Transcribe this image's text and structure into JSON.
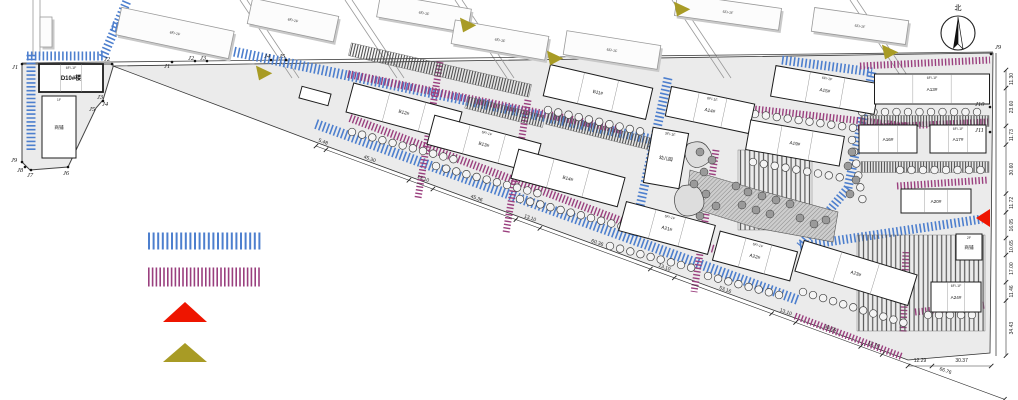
{
  "north_label": "北",
  "colors": {
    "road_main_hatch": "#4d7fce",
    "road_secondary_hatch": "#9a3f7e",
    "arrow_red": "#ee1500",
    "arrow_olive": "#a89b25",
    "site_fill": "#ebebeb"
  },
  "legend": {
    "items": [
      {
        "name": "legend-main-road-hatch",
        "kind": "hatch",
        "color": "#4d7fce"
      },
      {
        "name": "legend-secondary-road-hatch",
        "kind": "hatch",
        "color": "#9a3f7e"
      },
      {
        "name": "legend-red-entrance-arrow",
        "kind": "arrow",
        "color": "#ee1500"
      },
      {
        "name": "legend-olive-entrance-arrow",
        "kind": "arrow",
        "color": "#a89b25"
      }
    ]
  },
  "buildings": [
    {
      "label": "D10#楼",
      "sub": "6F/-1F",
      "x": 71,
      "y": 78,
      "w": 64,
      "h": 28,
      "rot": 0,
      "bold": true
    },
    {
      "label": "商铺",
      "sub": "1F",
      "x": 59,
      "y": 127,
      "w": 34,
      "h": 62,
      "rot": 0
    },
    {
      "label": "",
      "x": 315,
      "y": 96,
      "w": 30,
      "h": 12,
      "rot": 15
    },
    {
      "label": "B12#",
      "x": 404,
      "y": 112,
      "w": 112,
      "h": 30,
      "rot": 15
    },
    {
      "label": "B13#",
      "sub": "6F/-1F",
      "x": 484,
      "y": 144,
      "w": 110,
      "h": 30,
      "rot": 15
    },
    {
      "label": "B14#",
      "x": 568,
      "y": 178,
      "w": 110,
      "h": 30,
      "rot": 15
    },
    {
      "label": "B11#",
      "x": 598,
      "y": 92,
      "w": 105,
      "h": 32,
      "rot": 13
    },
    {
      "label": "A14#",
      "sub": "6F/-1F",
      "x": 710,
      "y": 110,
      "w": 85,
      "h": 30,
      "rot": 12
    },
    {
      "label": "A15#",
      "sub": "6F/-1F",
      "x": 825,
      "y": 90,
      "w": 105,
      "h": 31,
      "rot": 10
    },
    {
      "label": "A19#",
      "x": 795,
      "y": 143,
      "w": 95,
      "h": 30,
      "rot": 10
    },
    {
      "label": "幼儿园",
      "sub": "3F/-1F",
      "x": 666,
      "y": 158,
      "w": 36,
      "h": 56,
      "rot": 10
    },
    {
      "label": "A13#",
      "sub": "6F/-1F",
      "x": 932,
      "y": 89,
      "w": 115,
      "h": 30,
      "rot": 0
    },
    {
      "label": "A16#",
      "x": 888,
      "y": 139,
      "w": 58,
      "h": 28,
      "rot": 0
    },
    {
      "label": "A17#",
      "sub": "6F/-1F",
      "x": 958,
      "y": 139,
      "w": 56,
      "h": 28,
      "rot": 0
    },
    {
      "label": "A20#",
      "x": 936,
      "y": 201,
      "w": 70,
      "h": 24,
      "rot": 0
    },
    {
      "label": "A21#",
      "sub": "6F/-1F",
      "x": 667,
      "y": 228,
      "w": 92,
      "h": 30,
      "rot": 15
    },
    {
      "label": "A22#",
      "sub": "6F/-1F",
      "x": 755,
      "y": 256,
      "w": 80,
      "h": 30,
      "rot": 15
    },
    {
      "label": "A23#",
      "x": 856,
      "y": 273,
      "w": 118,
      "h": 32,
      "rot": 17
    },
    {
      "label": "A24#",
      "sub": "6F/-1F",
      "x": 956,
      "y": 297,
      "w": 50,
      "h": 30,
      "rot": 0
    },
    {
      "label": "商铺",
      "sub": "2F",
      "x": 969,
      "y": 247,
      "w": 26,
      "h": 26,
      "rot": 0
    }
  ],
  "context_buildings": [
    {
      "sub": "6F/-1F",
      "x": 175,
      "y": 33,
      "w": 115,
      "h": 28,
      "rot": 12
    },
    {
      "sub": "6F/-1F",
      "x": 293,
      "y": 20,
      "w": 88,
      "h": 26,
      "rot": 12
    },
    {
      "sub": "6F/-1F",
      "x": 424,
      "y": 13,
      "w": 92,
      "h": 24,
      "rot": 10
    },
    {
      "sub": "6F/-1F",
      "x": 500,
      "y": 40,
      "w": 95,
      "h": 24,
      "rot": 10
    },
    {
      "sub": "6F/-1F",
      "x": 612,
      "y": 50,
      "w": 95,
      "h": 24,
      "rot": 9
    },
    {
      "sub": "6F/-1F",
      "x": 728,
      "y": 12,
      "w": 105,
      "h": 22,
      "rot": 8
    },
    {
      "sub": "6F/-1F",
      "x": 860,
      "y": 26,
      "w": 95,
      "h": 24,
      "rot": 8
    },
    {
      "sub": "",
      "x": 46,
      "y": 32,
      "w": 12,
      "h": 30,
      "rot": 0
    }
  ],
  "j_points": [
    {
      "label": "J1",
      "x": 12,
      "y": 69,
      "dx": 22,
      "dy": 64
    },
    {
      "label": "J2",
      "x": 104,
      "y": 61,
      "dx": 112,
      "dy": 64
    },
    {
      "label": "J3",
      "x": 97,
      "y": 99,
      "dx": 103,
      "dy": 101
    },
    {
      "label": "J4",
      "x": 102,
      "y": 106
    },
    {
      "label": "J5",
      "x": 89,
      "y": 111
    },
    {
      "label": "J6",
      "x": 63,
      "y": 175,
      "dx": 68,
      "dy": 167
    },
    {
      "label": "J7",
      "x": 27,
      "y": 177,
      "dx": 31,
      "dy": 170
    },
    {
      "label": "J8",
      "x": 17,
      "y": 172,
      "dx": 25,
      "dy": 167
    },
    {
      "label": "J9",
      "x": 11,
      "y": 162,
      "dx": 22,
      "dy": 162
    },
    {
      "label": "J1",
      "x": 164,
      "y": 68,
      "dx": 172,
      "dy": 62
    },
    {
      "label": "J2",
      "x": 188,
      "y": 60,
      "dx": 195,
      "dy": 61
    },
    {
      "label": "J3",
      "x": 200,
      "y": 60,
      "dx": 207,
      "dy": 61
    },
    {
      "label": "J4",
      "x": 264,
      "y": 58,
      "dx": 271,
      "dy": 60
    },
    {
      "label": "J5",
      "x": 279,
      "y": 58,
      "dx": 286,
      "dy": 60
    },
    {
      "label": "J9",
      "x": 995,
      "y": 49,
      "dx": 991,
      "dy": 54
    },
    {
      "label": "J10",
      "x": 975,
      "y": 106,
      "dx": 990,
      "dy": 107
    },
    {
      "label": "J11",
      "x": 975,
      "y": 132,
      "dx": 990,
      "dy": 132
    }
  ],
  "dims_bottom": [
    {
      "v": "5.48"
    },
    {
      "v": "45.30"
    },
    {
      "v": "13.10"
    },
    {
      "v": "45.36"
    },
    {
      "v": "13.10"
    },
    {
      "v": "60.36"
    },
    {
      "v": "13.10"
    },
    {
      "v": "53.16"
    },
    {
      "v": "13.10"
    },
    {
      "v": "35.59"
    },
    {
      "v": "11.76"
    },
    {
      "v": "66.76"
    }
  ],
  "dims_right": [
    {
      "v": "11.30"
    },
    {
      "v": "23.60"
    },
    {
      "v": "11.73"
    },
    {
      "v": "30.60"
    },
    {
      "v": "11.72"
    },
    {
      "v": "16.05"
    },
    {
      "v": "10.65"
    },
    {
      "v": "17.00"
    },
    {
      "v": "11.46"
    },
    {
      "v": "34.43"
    }
  ],
  "dims_corner": [
    {
      "v": "12.29"
    },
    {
      "v": "30.37"
    }
  ]
}
